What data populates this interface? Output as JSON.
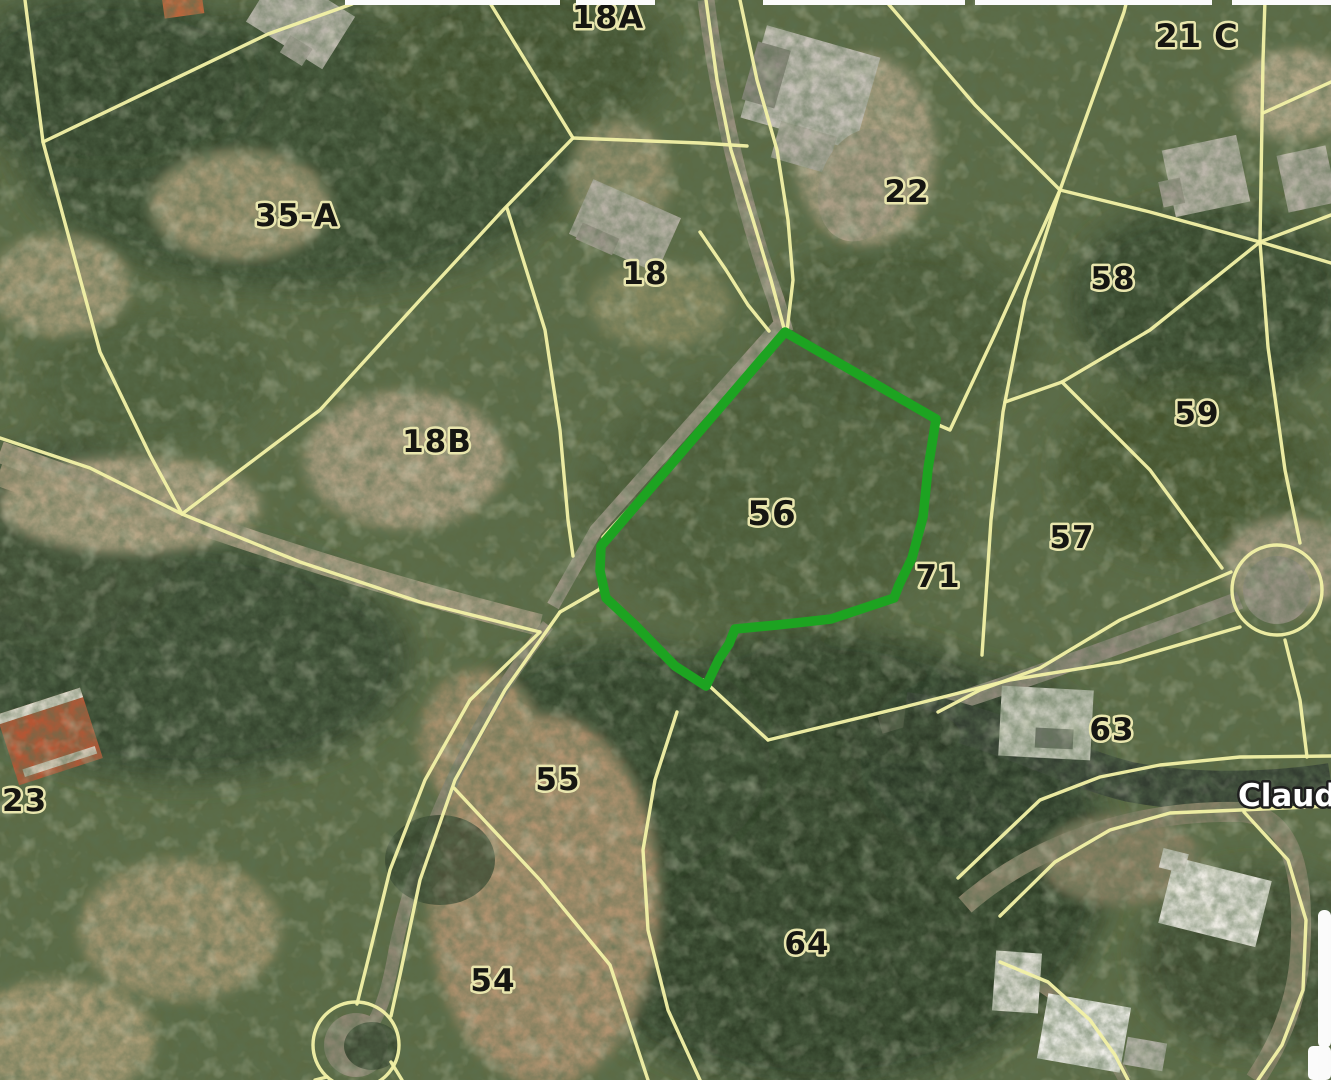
{
  "map": {
    "type": "aerial-parcel-map",
    "highlighted_parcel": {
      "label": "56",
      "outline_color": "#1da321",
      "points": "785,332 936,419 928,469 923,517 912,558 899,585 894,598 831,619 777,625 735,629 729,644 719,659 706,686 675,666 635,625 606,598 600,571 601,546"
    },
    "parcel_labels": [
      {
        "text": "18A",
        "x": 608,
        "y": 28,
        "size": 32,
        "anchor": "middle"
      },
      {
        "text": "21 C",
        "x": 1197,
        "y": 47,
        "size": 32,
        "anchor": "middle"
      },
      {
        "text": "35-A",
        "x": 297,
        "y": 226,
        "size": 31,
        "anchor": "middle"
      },
      {
        "text": "22",
        "x": 907,
        "y": 202,
        "size": 31,
        "anchor": "middle"
      },
      {
        "text": "18",
        "x": 645,
        "y": 284,
        "size": 31,
        "anchor": "middle"
      },
      {
        "text": "58",
        "x": 1113,
        "y": 289,
        "size": 31,
        "anchor": "middle"
      },
      {
        "text": "18B",
        "x": 437,
        "y": 452,
        "size": 31,
        "anchor": "middle"
      },
      {
        "text": "59",
        "x": 1197,
        "y": 424,
        "size": 31,
        "anchor": "middle"
      },
      {
        "text": "56",
        "x": 772,
        "y": 525,
        "size": 34,
        "anchor": "middle"
      },
      {
        "text": "57",
        "x": 1072,
        "y": 548,
        "size": 31,
        "anchor": "middle"
      },
      {
        "text": "71",
        "x": 938,
        "y": 587,
        "size": 31,
        "anchor": "middle"
      },
      {
        "text": "63",
        "x": 1112,
        "y": 740,
        "size": 31,
        "anchor": "middle"
      },
      {
        "text": "23",
        "x": 2,
        "y": 811,
        "size": 31,
        "anchor": "start"
      },
      {
        "text": "55",
        "x": 558,
        "y": 790,
        "size": 31,
        "anchor": "middle"
      },
      {
        "text": "54",
        "x": 493,
        "y": 991,
        "size": 31,
        "anchor": "middle"
      },
      {
        "text": "64",
        "x": 807,
        "y": 954,
        "size": 31,
        "anchor": "middle"
      }
    ],
    "street_labels": [
      {
        "text": "Claud",
        "x": 1238,
        "y": 806,
        "size": 31,
        "anchor": "start"
      }
    ],
    "boundary_lines": {
      "color": "#f1f0a6",
      "paths": [
        "25,0 43,142 100,352 150,455 182,514",
        "43,142 268,34 352,4",
        "490,3 573,138",
        "573,138 700,143 747,146",
        "573,138 505,208 420,300 320,410 182,514",
        "507,208 545,330 560,430 568,520 573,556",
        "706,0 717,80 731,150 753,220 771,280 785,332",
        "740,0 757,80 777,150 788,220 793,280 787,331",
        "700,232 726,270 748,305 769,331",
        "785,332 700,432 603,537 600,589 560,612",
        "0,438 90,468 182,514 300,562 420,602 540,632",
        "540,632 470,700 425,780 390,870 368,960 357,1004",
        "560,612 505,690 455,780 420,880 400,975 391,1016",
        "454,788 540,880 610,965 648,1080",
        "677,712 655,780 643,850 648,930 668,1010 700,1080",
        "703,680 768,740",
        "885,0 975,105 1060,190",
        "1060,190 1124,12 1127,0",
        "1060,190 1150,212 1260,242",
        "1060,190 997,330 950,430 936,424",
        "1060,190 1025,300 1003,412 991,520 982,655",
        "1260,242 1263,60 1265,0",
        "1260,242 1331,215",
        "1260,242 1331,263",
        "1331,82 1263,113",
        "1260,242 1150,330 1062,382",
        "1062,382 1005,402",
        "1062,382 1150,470 1222,568",
        "1260,242 1268,347 1285,470 1300,543",
        "1231,572 1120,620 1040,668 980,690 938,712",
        "1240,627 1120,662 1010,680 900,708 768,740",
        "958,878 1040,800 1100,777 1160,765 1240,757 1331,756",
        "1000,916 1055,862 1110,830 1170,813 1240,810 1331,806",
        "1244,812 1288,860 1306,920 1303,990 1282,1045 1258,1080",
        "1000,962 1048,982 1090,1020 1115,1055 1128,1080",
        "1285,640 1300,700 1307,757",
        "327,1077 315,1080",
        "391,1062 402,1080"
      ]
    },
    "culdesacs": [
      {
        "cx": 356,
        "cy": 1045,
        "r": 43
      },
      {
        "cx": 1277,
        "cy": 590,
        "r": 45
      }
    ],
    "ui": {
      "top_strip_segments": [
        {
          "x": 345,
          "w": 215
        },
        {
          "x": 576,
          "w": 79
        },
        {
          "x": 763,
          "w": 202
        },
        {
          "x": 975,
          "w": 237
        },
        {
          "x": 1232,
          "w": 99
        }
      ],
      "right_scrollbar": {
        "x": 1318,
        "y": 910,
        "w": 13,
        "h": 138
      },
      "corner_panel": {
        "x": 1308,
        "y": 1046,
        "w": 23,
        "h": 34
      }
    }
  }
}
